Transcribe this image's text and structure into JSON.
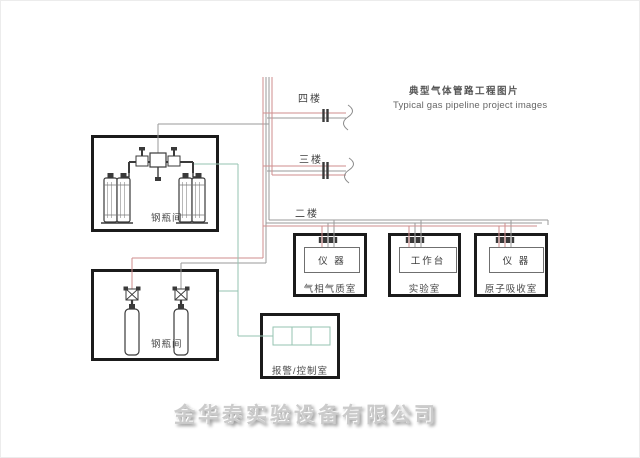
{
  "title": {
    "zh": "典型气体管路工程图片",
    "en": "Typical gas pipeline project images"
  },
  "floors": {
    "fourth": "四楼",
    "third": "三楼",
    "second": "二楼"
  },
  "rooms": {
    "cylinder_top": "钢瓶间",
    "cylinder_bottom": "钢瓶间"
  },
  "labs": [
    {
      "name": "气相气质室",
      "device": "仪 器"
    },
    {
      "name": "实验室",
      "device": "工作台"
    },
    {
      "name": "原子吸收室",
      "device": "仪 器"
    }
  ],
  "control_room": {
    "label": "报警/控制室"
  },
  "watermark": {
    "text": "金华泰实验设备有限公司"
  },
  "colors": {
    "pipe_red": "#cf8d8d",
    "pipe_gray": "#9a9a9a",
    "pipe_teal": "#96c3b2",
    "valve_dark": "#3a3a3a",
    "equipment_dark": "#3a3a3a",
    "box_border": "#1b1b1b",
    "watermark_gray": "#cbcbcb"
  }
}
